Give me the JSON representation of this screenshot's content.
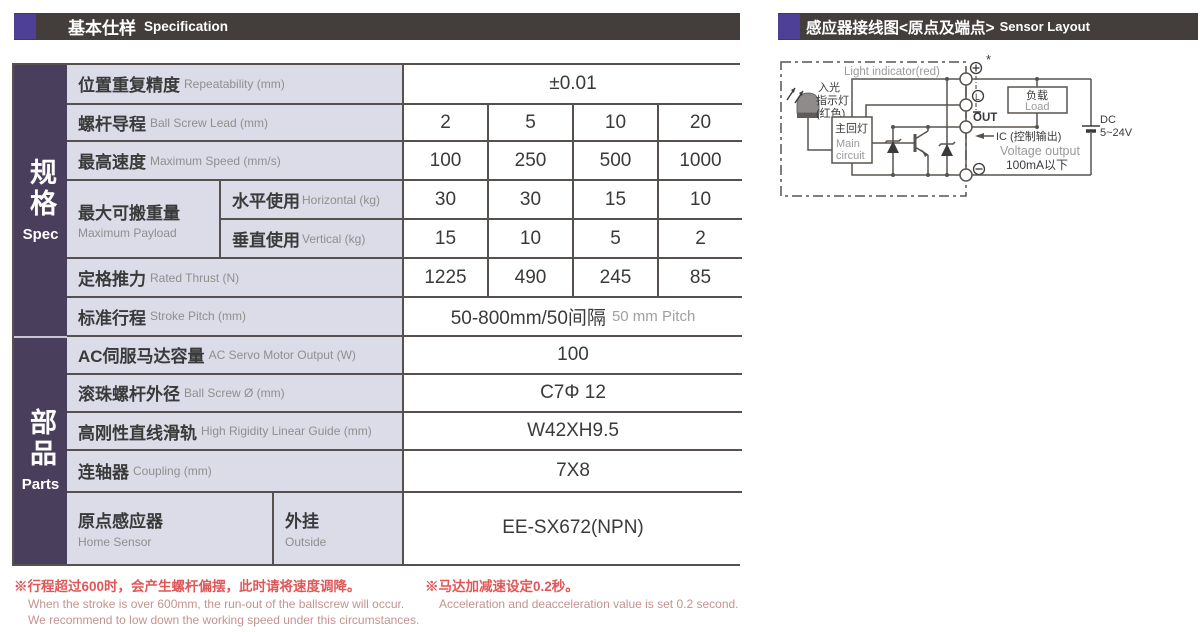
{
  "left_panel": {
    "header": {
      "title_zh": "基本仕样",
      "title_en": "Specification"
    },
    "sidebar": [
      {
        "zh": "规格",
        "en": "Spec"
      },
      {
        "zh": "部品",
        "en": "Parts"
      }
    ],
    "rows": [
      {
        "zh": "位置重复精度",
        "en": "Repeatability (mm)",
        "values": [
          "±0.01"
        ]
      },
      {
        "zh": "螺杆导程",
        "en": "Ball Screw Lead (mm)",
        "values": [
          "2",
          "5",
          "10",
          "20"
        ]
      },
      {
        "zh": "最高速度",
        "en": "Maximum Speed (mm/s)",
        "values": [
          "100",
          "250",
          "500",
          "1000"
        ]
      },
      {
        "zh": "最大可搬重量",
        "en": "Maximum Payload",
        "subrows": [
          {
            "zh": "水平使用",
            "en": "Horizontal (kg)",
            "values": [
              "30",
              "30",
              "15",
              "10"
            ]
          },
          {
            "zh": "垂直使用",
            "en": "Vertical (kg)",
            "values": [
              "15",
              "10",
              "5",
              "2"
            ]
          }
        ]
      },
      {
        "zh": "定格推力",
        "en": "Rated Thrust (N)",
        "values": [
          "1225",
          "490",
          "245",
          "85"
        ]
      },
      {
        "zh": "标准行程",
        "en": "Stroke Pitch (mm)",
        "value_zh": "50-800mm/50间隔",
        "value_en": "50 mm Pitch"
      },
      {
        "zh": "AC伺服马达容量",
        "en": "AC Servo Motor Output (W)",
        "values": [
          "100"
        ]
      },
      {
        "zh": "滚珠螺杆外径",
        "en": "Ball Screw Ø (mm)",
        "values": [
          "C7Φ 12"
        ]
      },
      {
        "zh": "高刚性直线滑轨",
        "en": "High Rigidity Linear Guide (mm)",
        "values": [
          "W42XH9.5"
        ]
      },
      {
        "zh": "连轴器",
        "en": "Coupling (mm)",
        "values": [
          "7X8"
        ]
      },
      {
        "zh": "原点感应器",
        "en": "Home Sensor",
        "sub_zh": "外挂",
        "sub_en": "Outside",
        "values": [
          "EE-SX672(NPN)"
        ]
      }
    ],
    "notes": [
      {
        "zh": "※行程超过600时，会产生螺杆偏摆，此时请将速度调降。",
        "en1": "When the stroke is over 600mm, the run-out of the ballscrew will occur.",
        "en2": "We recommend to low down the working speed under this circumstances."
      },
      {
        "zh": "※马达加减速设定0.2秒。",
        "en1": "Acceleration and deacceleration value is set 0.2 second.",
        "en2": ""
      }
    ]
  },
  "right_panel": {
    "header": {
      "title_zh": "感应器接线图<原点及端点>",
      "title_en": "Sensor Layout"
    },
    "diagram": {
      "light_indicator_en": "Light indicator(red)",
      "light_zh1": "入光",
      "light_zh2": "指示灯",
      "light_zh3": "(红色)",
      "main_circuit_zh": "主回灯",
      "main_circuit_en1": "Main",
      "main_circuit_en2": "circuit",
      "out_label": "OUT",
      "ic_label": "IC (控制输出)",
      "voltage_output": "Voltage output",
      "current_limit": "100mA以下",
      "load_zh": "负载",
      "load_en": "Load",
      "dc_label": "DC",
      "dc_range": "5~24V",
      "asterisk": "*",
      "terminal_plus": "+",
      "terminal_minus": "−",
      "terminal_l": "L"
    }
  },
  "colors": {
    "header_bg": "#433d3c",
    "header_accent": "#4e4097",
    "sidebar_bg": "#4a3e5d",
    "label_cell_bg": "#dbdce8",
    "table_border": "#56514f",
    "note_red": "#e05757",
    "note_salmon": "#c4938d"
  }
}
